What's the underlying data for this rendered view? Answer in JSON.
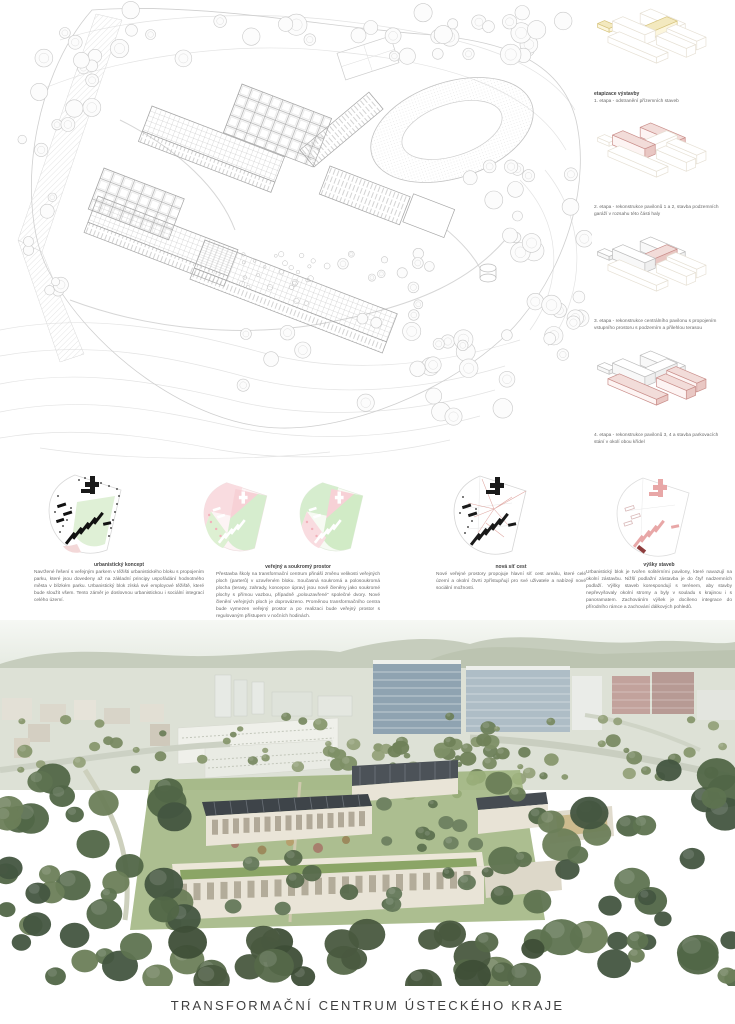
{
  "title": "TRANSFORMAČNÍ CENTRUM ÚSTECKÉHO KRAJE",
  "phasing": {
    "heading": "etapizace výstavby",
    "phases": [
      {
        "caption": "1. etapa - odstranění přízemních staveb"
      },
      {
        "caption": "2. etapa - rekonstrukce pavilonů 1 a 2, stavba podzemních garáží v rozsahu této části haly"
      },
      {
        "caption": "3. etapa - rekonstrukce centrálního pavilonu s propojením vstupního prostoru s podzemím a přilehlou terasou"
      },
      {
        "caption": "4. etapa - rekonstrukce pavilonů 3, 4 a stavba parkovacích stání v okolí obou křídel"
      }
    ],
    "accent_red": "#c98e8a",
    "accent_yellow": "#d6c37c"
  },
  "concepts": [
    {
      "heading": "urbanistický koncept",
      "text": "Navržené řešení s veřejným parkem v těžišti urbanistického bloku s propojením parku, které jsou dovedeny až na základní principy uspořádání hodnotného města v blízkém parku. Urbanistický blok získá své employové těžiště, které bude sloužit všem. Tento záměr je doslovnou urbanistickou i sociální integrací celého území."
    },
    {
      "heading": "veřejný a soukromý prostor",
      "text": "Přestavba školy na transformační centrum přináší změnu velikosti veřejných ploch (parterů) v uzavřeném bloku. Současná soukromá a polosoukromá plocha (terasy, zahrady, koncepce úprav) jsou nově členěny jako soukromé plochy s přímou vazbou, případně „polouzavřené“ společné dvory. Nové členění veřejných ploch je doprovázeno. Proměnou transformačního centra bude vymezen veřejný prostor a po realizaci bude veřejný prostor s regulovaným přístupem v nočních hodinách."
    },
    {
      "heading": "nová síť cest",
      "text": "Nové veřejné prostory propojuje hlavní síť cest areálu, které celé území a okolní čtvrti zpřístupňují pro své uživatele a nabízejí nové sociální možnosti."
    },
    {
      "heading": "výšky staveb",
      "text": "Urbanistický blok je tvořen solitérními pavilony, které navazují na okolní zástavbu. Nižší podlažní zástavba je do čtyř nadzemních podlaží. Výšky staveb korespondují s terénem, aby stavby nepřevyšovaly okolní stromy a byly v souladu s krajinou i s panoramatem. Zachováním výšek je docíleno integrace do přírodního rámce a zachování dálkových pohledů."
    }
  ],
  "legend_colors": {
    "public_pink": "#f8cdd3",
    "private_green": "#cfeac6",
    "existing_black": "#1a1a1a",
    "proposed_red": "#e8a7a7"
  }
}
